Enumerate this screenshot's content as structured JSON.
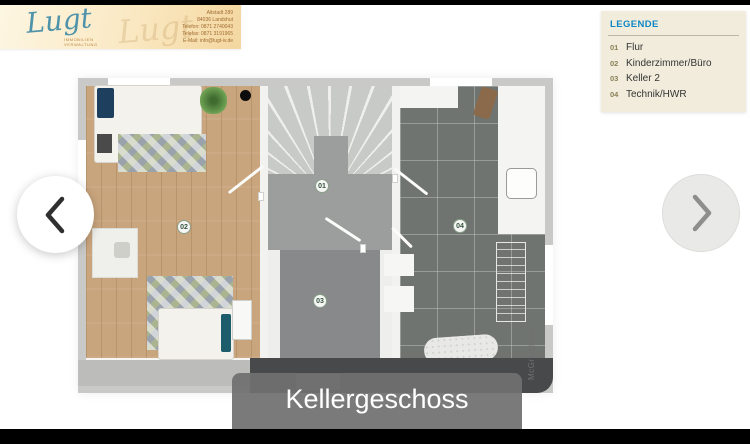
{
  "letterhead": {
    "brand": "Lugt",
    "brand_subtitle_line1": "IMMOBILIEN",
    "brand_subtitle_line2": "VERWALTUNG",
    "address_lines": [
      "Altstadt 289",
      "84036 Landshut",
      "Telefon: 0871 2740043",
      "Telefax: 0871 3191965",
      "E-Mail: info@lugt-iv.de"
    ]
  },
  "legend": {
    "title": "LEGENDE",
    "items": [
      {
        "num": "01",
        "label": "Flur"
      },
      {
        "num": "02",
        "label": "Kinderzimmer/Büro"
      },
      {
        "num": "03",
        "label": "Keller 2"
      },
      {
        "num": "04",
        "label": "Technik/HWR"
      }
    ]
  },
  "plan": {
    "labels": [
      {
        "num": "01"
      },
      {
        "num": "02"
      },
      {
        "num": "03"
      },
      {
        "num": "04"
      }
    ],
    "watermark": "McGrundriss"
  },
  "caption": {
    "title": "Kellergeschoss"
  },
  "carousel": {
    "prev_icon": "chevron-left",
    "next_icon": "chevron-right"
  },
  "colors": {
    "legend_title": "#0f86c6",
    "legend_bg": "#f1ecdb",
    "brand_teal": "#4e93aa",
    "caption_bg": "#707070"
  }
}
